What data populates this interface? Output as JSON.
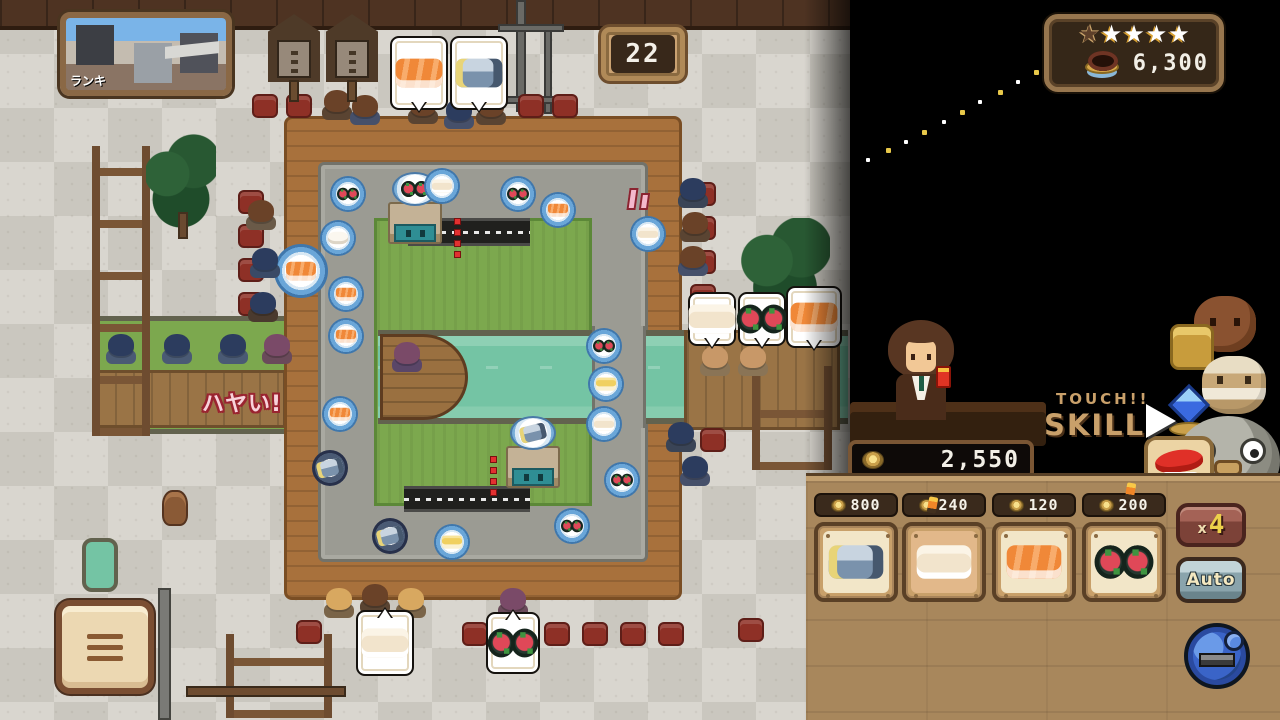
{
  "hud": {
    "ranking_photo_label": "ランキ",
    "order_counter": "22",
    "score_panel": {
      "stars": [
        "dark",
        "light",
        "light",
        "light",
        "light"
      ],
      "money": "6,300"
    },
    "wallet_amount": "2,550",
    "touch_label": "TOUCH!!",
    "skill_label": "SKILL",
    "impatience_text": "ハヤい!"
  },
  "shop": {
    "items": [
      {
        "name": "saba-sushi",
        "icon": "saba",
        "price": "800",
        "selected": false,
        "marker": false
      },
      {
        "name": "ika-sushi",
        "icon": "ika",
        "price": "240",
        "selected": true,
        "marker": true
      },
      {
        "name": "salmon-sushi",
        "icon": "salmon",
        "price": "120",
        "selected": false,
        "marker": false
      },
      {
        "name": "tuna-maki",
        "icon": "maki",
        "price": "200",
        "selected": false,
        "marker": true
      }
    ],
    "multiplier_small": "x",
    "multiplier_big": "4",
    "auto_label": "Auto"
  },
  "colors": {
    "gold": "#e8c84a",
    "wood_panel": "#a8875c",
    "hud_tan": "#c9a06a",
    "belt_grey": "#9b9b93",
    "river_teal": "#74c4a4",
    "stool_red": "#8e3026",
    "price_bar": "#3a2a1c"
  },
  "scene": {
    "stools": [
      [
        252,
        94
      ],
      [
        286,
        94
      ],
      [
        518,
        94
      ],
      [
        552,
        94
      ],
      [
        238,
        190
      ],
      [
        238,
        224
      ],
      [
        238,
        258
      ],
      [
        238,
        292
      ],
      [
        690,
        182
      ],
      [
        690,
        216
      ],
      [
        690,
        250
      ],
      [
        690,
        284
      ],
      [
        296,
        620
      ],
      [
        462,
        622
      ],
      [
        544,
        622
      ],
      [
        582,
        622
      ],
      [
        620,
        622
      ],
      [
        658,
        622
      ],
      [
        738,
        618
      ],
      [
        700,
        428
      ]
    ],
    "customers": [
      [
        322,
        90,
        "brown",
        "#5a4432"
      ],
      [
        350,
        95,
        "brown",
        "#46506a"
      ],
      [
        408,
        94,
        "brown",
        "#5a4432"
      ],
      [
        444,
        99,
        "darkblue",
        "#46506a"
      ],
      [
        476,
        95,
        "brown",
        "#5a4432"
      ],
      [
        246,
        200,
        "brown",
        "#6a5a48"
      ],
      [
        250,
        248,
        "darkblue",
        "#3a4a66"
      ],
      [
        248,
        292,
        "darkblue",
        "#4a3a2e"
      ],
      [
        106,
        334,
        "darkblue",
        "#4a5a74"
      ],
      [
        162,
        334,
        "darkblue",
        "#4a5a74"
      ],
      [
        218,
        334,
        "darkblue",
        "#4a5a74"
      ],
      [
        262,
        334,
        "purple",
        "#6a4a5a"
      ],
      [
        678,
        178,
        "darkblue",
        "#3a4456"
      ],
      [
        680,
        212,
        "brown",
        "#5a4432"
      ],
      [
        678,
        246,
        "brown",
        "#46506a"
      ],
      [
        700,
        346,
        "tan",
        "#8a7456"
      ],
      [
        738,
        346,
        "tan",
        "#8a7456"
      ],
      [
        666,
        422,
        "darkblue",
        "#3a4456"
      ],
      [
        680,
        456,
        "darkblue",
        "#46506a"
      ],
      [
        324,
        588,
        "blonde",
        "#7a6448"
      ],
      [
        360,
        584,
        "brown",
        "#5a4432"
      ],
      [
        396,
        588,
        "blonde",
        "#7a6448"
      ],
      [
        498,
        588,
        "purple",
        "#6a4a5a"
      ],
      [
        392,
        342,
        "purple",
        "#5a4668"
      ]
    ],
    "plates": [
      [
        330,
        176,
        "maki"
      ],
      [
        424,
        168,
        "ika"
      ],
      [
        500,
        176,
        "maki"
      ],
      [
        540,
        192,
        "salmon"
      ],
      [
        630,
        216,
        "ika"
      ],
      [
        320,
        220,
        "rice"
      ],
      [
        328,
        276,
        "salmon"
      ],
      [
        328,
        318,
        "salmon"
      ],
      [
        322,
        396,
        "salmon"
      ],
      [
        312,
        450,
        "saba"
      ],
      [
        372,
        518,
        "saba"
      ],
      [
        434,
        524,
        "tamago"
      ],
      [
        554,
        508,
        "maki"
      ],
      [
        604,
        462,
        "maki"
      ],
      [
        586,
        406,
        "ika"
      ],
      [
        588,
        366,
        "tamago"
      ],
      [
        586,
        328,
        "maki"
      ],
      [
        274,
        244,
        "salmon"
      ]
    ],
    "big_plate_index": 17,
    "machines": [
      [
        386,
        178,
        "maki"
      ],
      [
        504,
        422,
        "saba"
      ]
    ],
    "tunnels": [
      [
        408,
        218,
        122,
        28
      ],
      [
        404,
        486,
        126,
        26
      ]
    ],
    "red_dots": [
      [
        454,
        218
      ],
      [
        490,
        456
      ]
    ],
    "bubbles": [
      [
        390,
        36,
        58,
        74,
        "salmon",
        "b"
      ],
      [
        450,
        36,
        58,
        74,
        "saba",
        "b"
      ],
      [
        688,
        292,
        48,
        54,
        "ika",
        "b"
      ],
      [
        738,
        292,
        48,
        54,
        "maki",
        "b"
      ],
      [
        786,
        286,
        56,
        62,
        "salmon",
        "b"
      ],
      [
        356,
        610,
        58,
        66,
        "ika",
        "t"
      ],
      [
        486,
        612,
        54,
        62,
        "maki",
        "t"
      ]
    ],
    "signs": [
      [
        268,
        14
      ],
      [
        326,
        14
      ]
    ],
    "trail": [
      [
        866,
        158
      ],
      [
        886,
        148
      ],
      [
        904,
        140
      ],
      [
        922,
        130
      ],
      [
        942,
        120
      ],
      [
        960,
        110
      ],
      [
        978,
        100
      ],
      [
        998,
        90
      ],
      [
        1016,
        80
      ],
      [
        1034,
        70
      ]
    ]
  }
}
